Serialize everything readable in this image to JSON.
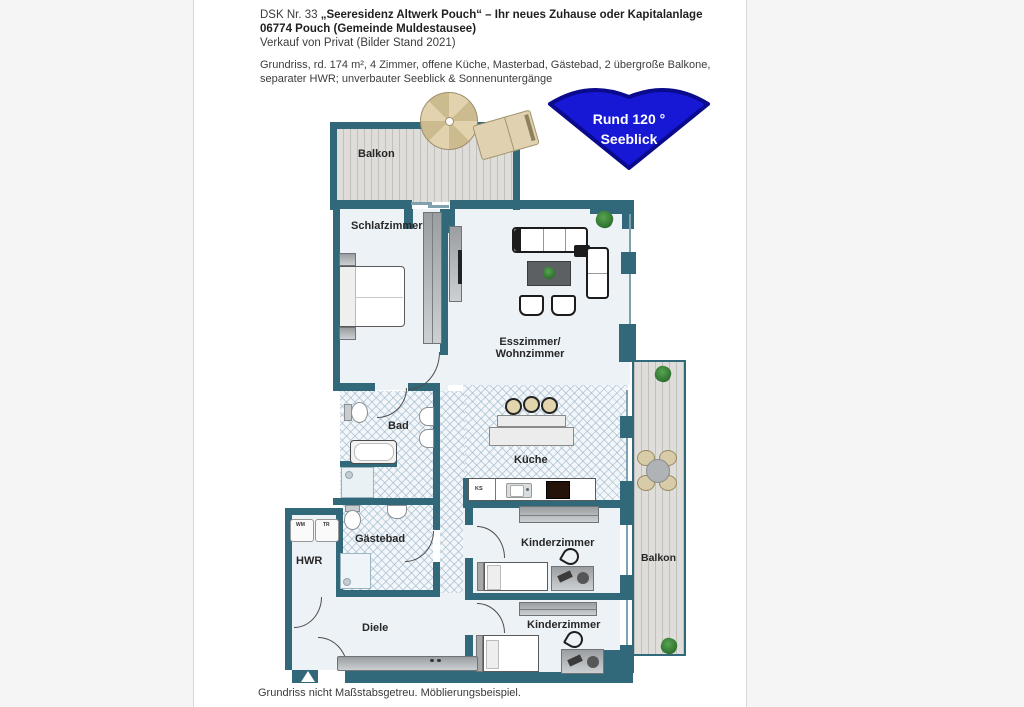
{
  "header": {
    "line1_prefix": "DSK Nr. 33 ",
    "line1_bold": "„Seeresidenz Altwerk Pouch“ – Ihr neues Zuhause oder Kapitalanlage",
    "line2": "06774 Pouch (Gemeinde Muldestausee)",
    "line3": "Verkauf von Privat (Bilder Stand 2021)",
    "description_line1": "Grundriss, rd. 174 m², 4 Zimmer, offene Küche, Masterbad, Gästebad, 2 übergroße Balkone,",
    "description_line2": "separater HWR; unverbauter Seeblick & Sonnenuntergänge"
  },
  "badge": {
    "line1": "Rund 120 °",
    "line2": "Seeblick",
    "fill": "#1717d6",
    "border": "#0a0a8c"
  },
  "rooms": {
    "balkon_top": "Balkon",
    "schlafzimmer": "Schlafzimmer",
    "wohnbereich_line1": "Esszimmer/",
    "wohnbereich_line2": "Wohnzimmer",
    "bad": "Bad",
    "kueche": "Küche",
    "gaestebad": "Gästebad",
    "hwr": "HWR",
    "kinderzimmer_1": "Kinderzimmer",
    "kinderzimmer_2": "Kinderzimmer",
    "diele": "Diele",
    "balkon_right": "Balkon"
  },
  "labels": {
    "wm": "WM",
    "tr": "TR",
    "ks": "KS"
  },
  "footer": "Grundriss nicht Maßstabsgetreu. Möblierungsbeispiel.",
  "colors": {
    "wall": "#31687a",
    "floor": "#edf2f7",
    "paper": "#ffffff",
    "page_bg": "#f5f5f6"
  }
}
